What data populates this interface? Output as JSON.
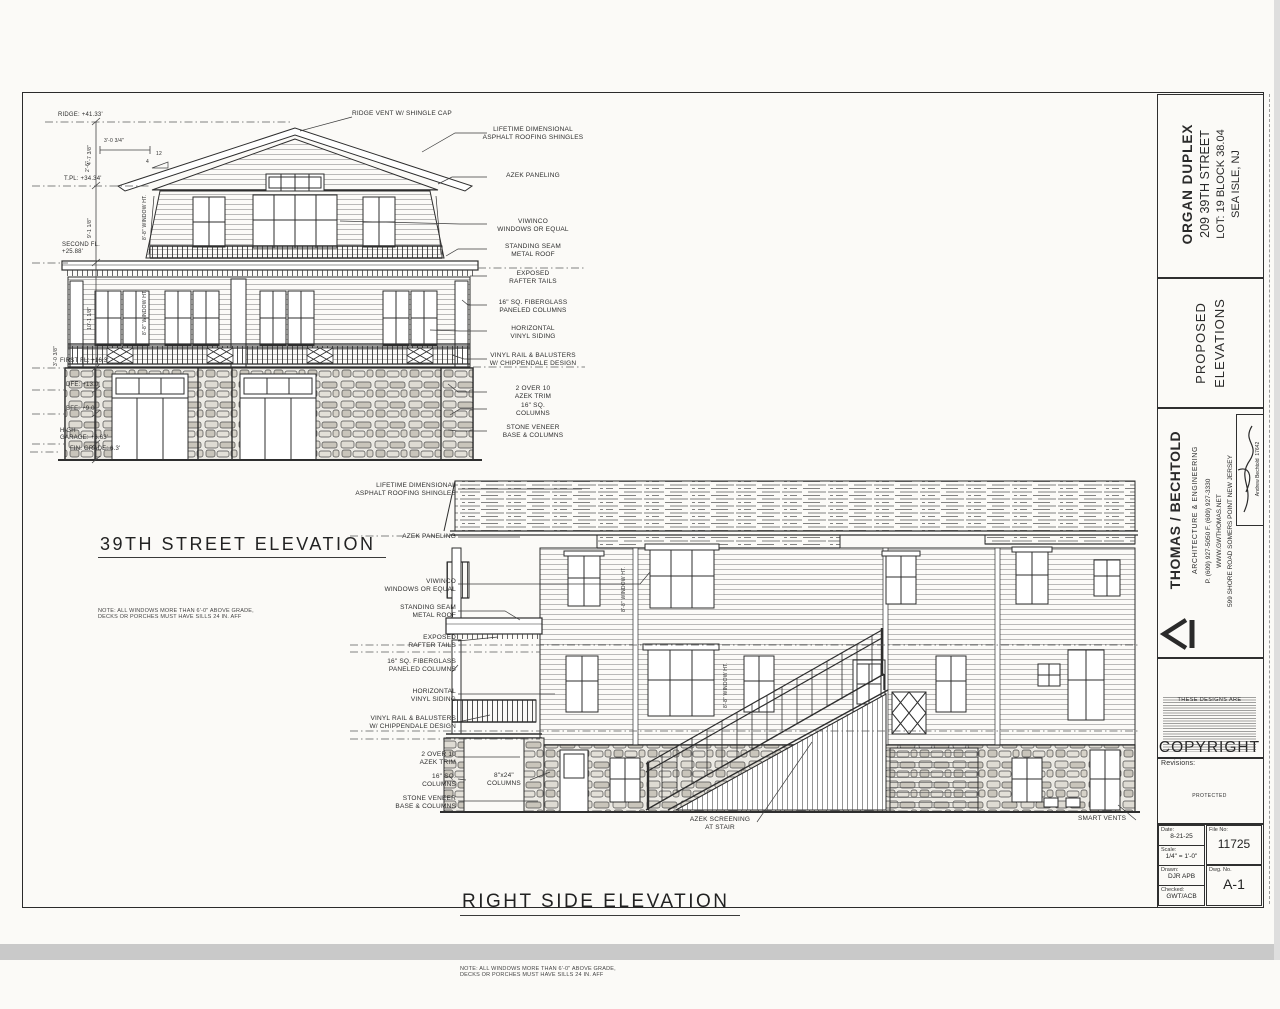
{
  "front": {
    "title": "39TH STREET ELEVATION",
    "note1": "NOTE: ALL WINDOWS MORE THAN 6'-0\" ABOVE GRADE,",
    "note2": "DECKS OR PORCHES MUST HAVE SILLS 24 IN. AFF",
    "top_callout": "RIDGE VENT W/ SHINGLE CAP",
    "callouts": [
      {
        "l1": "LIFETIME DIMENSIONAL",
        "l2": "ASPHALT ROOFING SHINGLES"
      },
      {
        "l1": "AZEK PANELING",
        "l2": ""
      },
      {
        "l1": "VIWINCO",
        "l2": "WINDOWS OR EQUAL"
      },
      {
        "l1": "STANDING SEAM",
        "l2": "METAL ROOF"
      },
      {
        "l1": "EXPOSED",
        "l2": "RAFTER TAILS"
      },
      {
        "l1": "16\" SQ. FIBERGLASS",
        "l2": "PANELED COLUMNS"
      },
      {
        "l1": "HORIZONTAL",
        "l2": "VINYL SIDING"
      },
      {
        "l1": "VINYL RAIL & BALUSTERS",
        "l2": "W/ CHIPPENDALE DESIGN"
      },
      {
        "l1": "2 OVER 10",
        "l2": "AZEK TRIM"
      },
      {
        "l1": "16\" SQ.",
        "l2": "COLUMNS"
      },
      {
        "l1": "STONE VENEER",
        "l2": "BASE & COLUMNS"
      }
    ],
    "datums": [
      {
        "l1": "RIDGE: +41.33'",
        "l2": ""
      },
      {
        "l1": "T.PL: +34.34'",
        "l2": ""
      },
      {
        "l1": "SECOND FL.",
        "l2": "+25.88'"
      },
      {
        "l1": "FIRST FL: +16.3'",
        "l2": ""
      },
      {
        "l1": "DFE: +13.0'",
        "l2": ""
      },
      {
        "l1": "BFE: +9.0'",
        "l2": ""
      },
      {
        "l1": "HIGH",
        "l2": "GARAGE: +6.63'"
      },
      {
        "l1": "FIN. GRADE: 6.3'",
        "l2": ""
      }
    ],
    "dims": [
      "4'-7 3/8\"",
      "9'-1 1/8\"",
      "10'-1 1/8\"",
      "3'-0 3/8\"",
      "3'-0 3/4\"",
      "2'-6\"",
      "12",
      "4"
    ]
  },
  "side": {
    "title": "RIGHT SIDE ELEVATION",
    "note1": "NOTE: ALL WINDOWS MORE THAN 6'-0\" ABOVE GRADE,",
    "note2": "DECKS OR PORCHES MUST HAVE SILLS 24 IN. AFF",
    "callouts": [
      {
        "l1": "LIFETIME DIMENSIONAL",
        "l2": "ASPHALT ROOFING SHINGLES"
      },
      {
        "l1": "AZEK PANELING",
        "l2": ""
      },
      {
        "l1": "VIWINCO",
        "l2": "WINDOWS OR EQUAL"
      },
      {
        "l1": "STANDING SEAM",
        "l2": "METAL ROOF"
      },
      {
        "l1": "EXPOSED",
        "l2": "RAFTER TAILS"
      },
      {
        "l1": "16\" SQ. FIBERGLASS",
        "l2": "PANELED COLUMNS"
      },
      {
        "l1": "HORIZONTAL",
        "l2": "VINYL SIDING"
      },
      {
        "l1": "VINYL RAIL & BALUSTERS",
        "l2": "W/ CHIPPENDALE DESIGN"
      },
      {
        "l1": "2 OVER 10",
        "l2": "AZEK TRIM"
      },
      {
        "l1": "16\" SQ.",
        "l2": "COLUMNS"
      },
      {
        "l1": "STONE VENEER",
        "l2": "BASE & COLUMNS"
      }
    ],
    "column_label": {
      "l1": "8\"x24\"",
      "l2": "COLUMNS"
    },
    "stair_callout": {
      "l1": "AZEK SCREENING",
      "l2": "AT STAIR"
    },
    "vents_callout": "SMART VENTS"
  },
  "shared": {
    "window_ht": "8'-8\" WINDOW HT."
  },
  "titleblock": {
    "project": {
      "l1": "ORGAN DUPLEX",
      "l2": "209 39TH STREET",
      "l3": "LOT: 19  BLOCK 38.04",
      "l4": "SEA ISLE, NJ"
    },
    "sheet": {
      "l1": "PROPOSED",
      "l2": "ELEVATIONS"
    },
    "firm": {
      "name": "THOMAS / BECHTOLD",
      "tag": "ARCHITECTURE & ENGINEERING",
      "phones": "P. (609) 927-5050          F. (609) 927-3330",
      "web": "WWW.GWTHOMAS.NET",
      "addr": "599 SHORE ROAD   SOMERS POINT   NEW JERSEY",
      "sig_name": "Andrew Bechtold",
      "sig_no": "17642"
    },
    "copyright": {
      "pre": "THESE DESIGNS ARE",
      "word": "COPYRIGHT",
      "post": "PROTECTED"
    },
    "revisions_label": "Revisions:",
    "fields": {
      "date_l": "Date:",
      "date": "8-21-25",
      "scale_l": "Scale:",
      "scale": "1/4\" = 1'-0\"",
      "drawn_l": "Drawn:",
      "drawn": "DJR APB",
      "checked_l": "Checked:",
      "checked": "GWT/ACB",
      "file_l": "File No:",
      "file": "11725",
      "dwg_l": "Dwg. No.",
      "dwg": "A-1"
    }
  }
}
